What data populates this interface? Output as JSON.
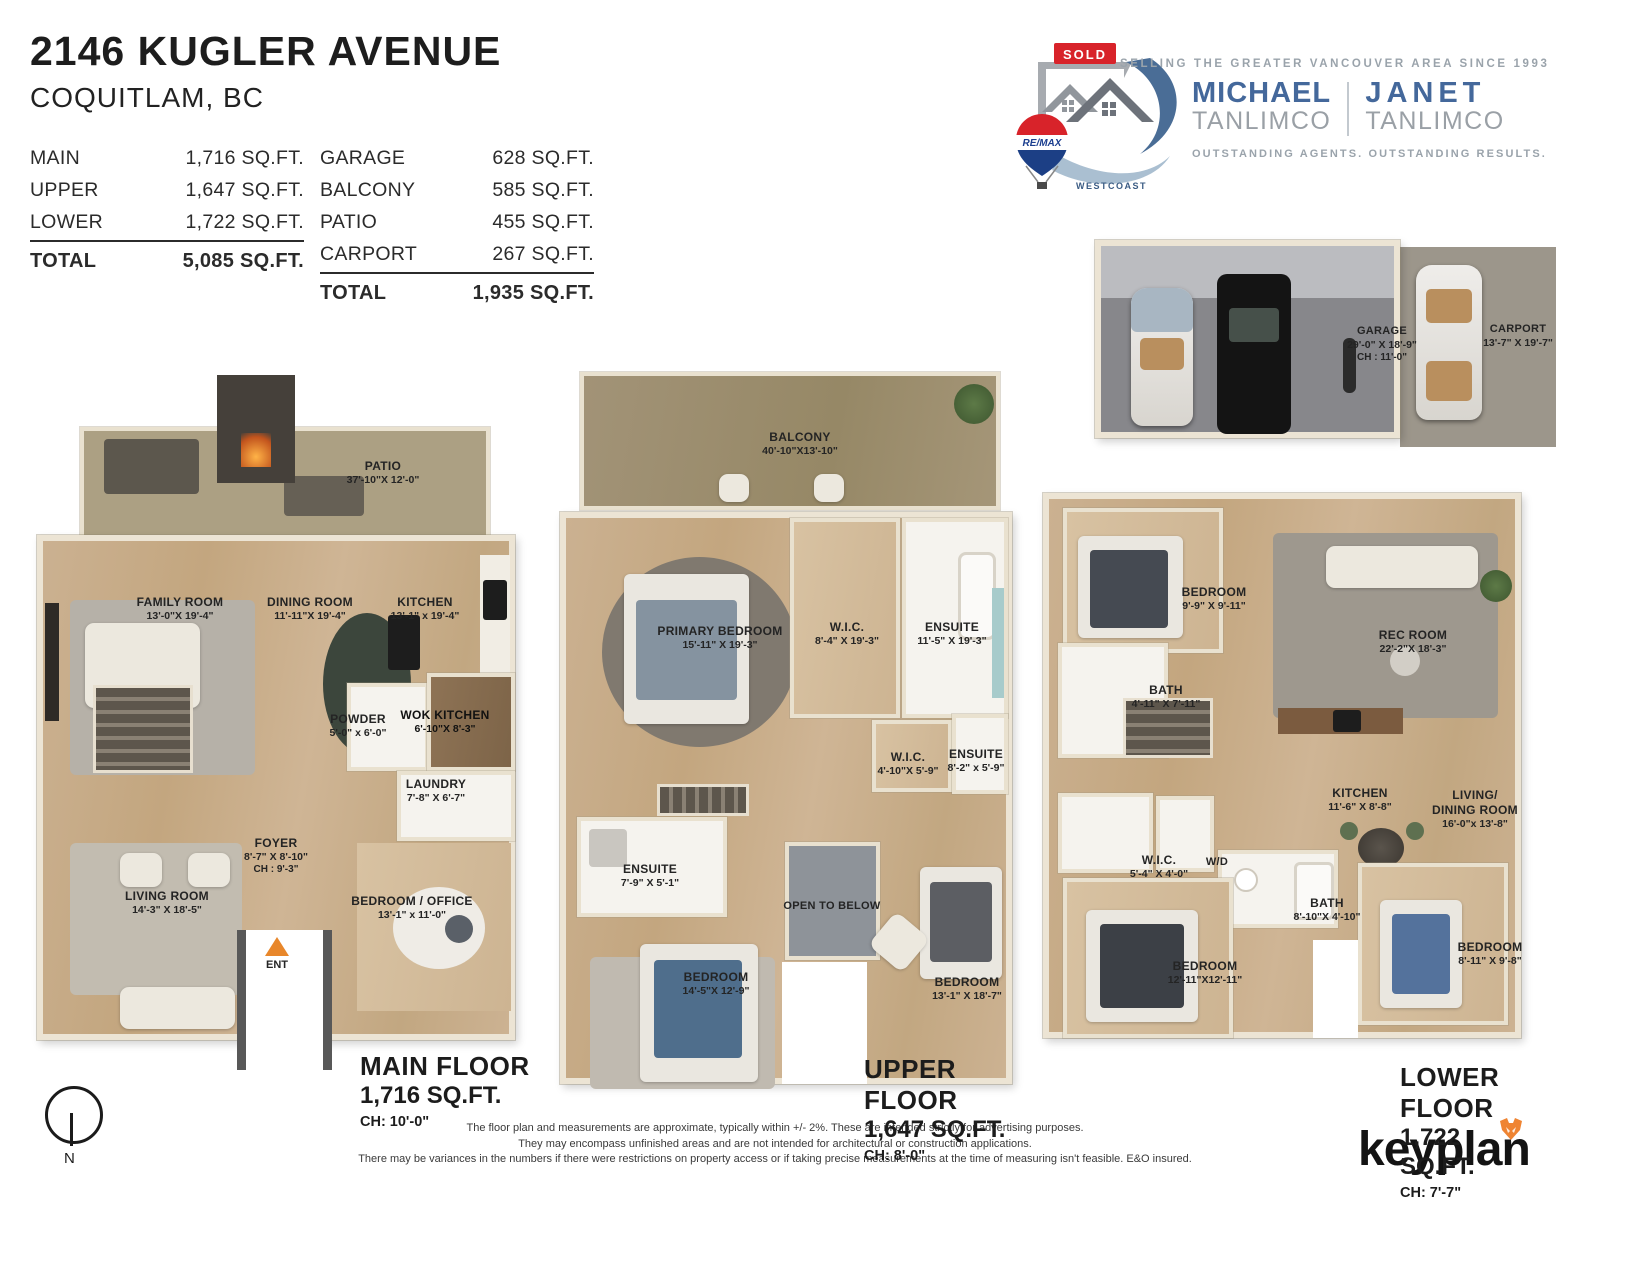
{
  "header": {
    "title": "2146 KUGLER AVENUE",
    "subtitle": "COQUITLAM, BC",
    "left_table": {
      "rows": [
        {
          "label": "MAIN",
          "value": "1,716 SQ.FT."
        },
        {
          "label": "UPPER",
          "value": "1,647 SQ.FT."
        },
        {
          "label": "LOWER",
          "value": "1,722 SQ.FT."
        }
      ],
      "total": {
        "label": "TOTAL",
        "value": "5,085 SQ.FT."
      }
    },
    "right_table": {
      "rows": [
        {
          "label": "GARAGE",
          "value": "628 SQ.FT."
        },
        {
          "label": "BALCONY",
          "value": "585 SQ.FT."
        },
        {
          "label": "PATIO",
          "value": "455 SQ.FT."
        },
        {
          "label": "CARPORT",
          "value": "267 SQ.FT."
        }
      ],
      "total": {
        "label": "TOTAL",
        "value": "1,935 SQ.FT."
      }
    }
  },
  "branding": {
    "sold": "SOLD",
    "remax": "RE/MAX",
    "westcoast": "WESTCOAST",
    "tagline_top": "SELLING THE GREATER VANCOUVER AREA SINCE 1993",
    "agents": [
      {
        "first": "MICHAEL",
        "last": "TANLIMCO"
      },
      {
        "first": "JANET",
        "last": "TANLIMCO"
      }
    ],
    "tagline_bottom": "OUTSTANDING AGENTS. OUTSTANDING RESULTS."
  },
  "garage_plan": {
    "garage": {
      "name": "GARAGE",
      "dims": "29'-0\" X  18'-9\"",
      "ch": "CH : 11'-0\""
    },
    "carport": {
      "name": "CARPORT",
      "dims": "13'-7\"  X  19'-7\""
    }
  },
  "floors": {
    "main": {
      "title": "MAIN FLOOR",
      "area": "1,716 SQ.FT.",
      "ch": "CH: 10'-0\"",
      "ent": "ENT",
      "rooms": {
        "patio": {
          "name": "PATIO",
          "dims": "37'-10\"X 12'-0\""
        },
        "family": {
          "name": "FAMILY ROOM",
          "dims": "13'-0\"X 19'-4\""
        },
        "dining": {
          "name": "DINING ROOM",
          "dims": "11'-11\"X 19'-4\""
        },
        "kitchen": {
          "name": "KITCHEN",
          "dims": "13'-1\" x 19'-4\""
        },
        "powder": {
          "name": "POWDER",
          "dims": "5'-0\" x 6'-0\""
        },
        "wok": {
          "name": "WOK KITCHEN",
          "dims": "6'-10\"X  8'-3\""
        },
        "laundry": {
          "name": "LAUNDRY",
          "dims": "7'-8\"  X  6'-7\""
        },
        "foyer": {
          "name": "FOYER",
          "dims": "8'-7\"  X  8'-10\"",
          "ch": "CH : 9'-3\""
        },
        "living": {
          "name": "LIVING ROOM",
          "dims": "14'-3\"  X  18'-5\""
        },
        "bedoffice": {
          "name": "BEDROOM / OFFICE",
          "dims": "13'-1\"  x  11'-0\""
        }
      }
    },
    "upper": {
      "title": "UPPER FLOOR",
      "area": "1,647 SQ.FT.",
      "ch": "CH: 8'-0\"",
      "rooms": {
        "balcony": {
          "name": "BALCONY",
          "dims": "40'-10\"X13'-10\""
        },
        "primary": {
          "name": "PRIMARY BEDROOM",
          "dims": "15'-11\" X 19'-3\""
        },
        "wic1": {
          "name": "W.I.C.",
          "dims": "8'-4\" X 19'-3\""
        },
        "ensuite1": {
          "name": "ENSUITE",
          "dims": "11'-5\" X 19'-3\""
        },
        "wic2": {
          "name": "W.I.C.",
          "dims": "4'-10\"X  5'-9\""
        },
        "ensuite2": {
          "name": "ENSUITE",
          "dims": "8'-2\" x 5'-9\""
        },
        "ensuite3": {
          "name": "ENSUITE",
          "dims": "7'-9\" X  5'-1\""
        },
        "open_below": {
          "name": "OPEN TO BELOW"
        },
        "bedroom1": {
          "name": "BEDROOM",
          "dims": "14'-5\"X 12'-9\""
        },
        "bedroom2": {
          "name": "BEDROOM",
          "dims": "13'-1\" X 18'-7\""
        }
      }
    },
    "lower": {
      "title": "LOWER FLOOR",
      "area": "1,722 SQ.FT.",
      "ch": "CH: 7'-7\"",
      "rooms": {
        "bedroom1": {
          "name": "BEDROOM",
          "dims": "9'-9\" X 9'-11\""
        },
        "rec": {
          "name": "REC ROOM",
          "dims": "22'-2\"X 18'-3\""
        },
        "bath1": {
          "name": "BATH",
          "dims": "4'-11\" X  7'-11\""
        },
        "kitchen": {
          "name": "KITCHEN",
          "dims": "11'-6\" X  8'-8\""
        },
        "livdin": {
          "name1": "LIVING/",
          "name2": "DINING ROOM",
          "dims": "16'-0\"x 13'-8\""
        },
        "wic": {
          "name": "W.I.C.",
          "dims": "5'-4\" X 4'-0\""
        },
        "wd": {
          "name": "W/D"
        },
        "bath2": {
          "name": "BATH",
          "dims": "8'-10\"X 4'-10\""
        },
        "bedroom2": {
          "name": "BEDROOM",
          "dims": "12'-11\"X12'-11\""
        },
        "bedroom3": {
          "name": "BEDROOM",
          "dims": "8'-11\" X  9'-8\""
        }
      }
    }
  },
  "compass": {
    "north": "N"
  },
  "footer": {
    "disclaimer1": "The floor plan and measurements are approximate, typically within +/- 2%. These are intended strictly for advertising purposes.",
    "disclaimer2": "They may encompass unfinished areas and are not intended for architectural or construction applications.",
    "disclaimer3": "There may be variances in the numbers if there were restrictions on property access or if taking precise measurements at the time of measuring isn't feasible. E&O insured.",
    "brand": "keyplan"
  }
}
